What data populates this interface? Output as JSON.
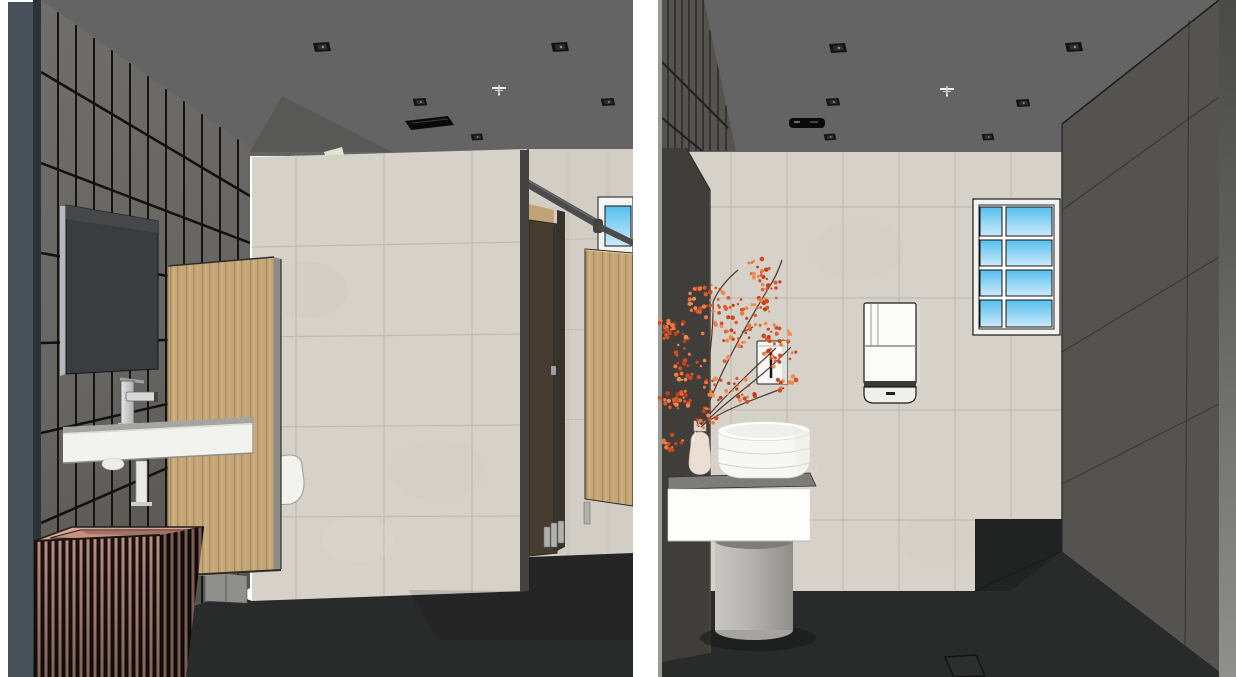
{
  "scene": {
    "description": "Two-view 3D interior rendering of a modern public restroom",
    "views": [
      {
        "id": "left-view",
        "elements": [
          "dark-tiled-wall",
          "wall-mirror",
          "chrome-faucet",
          "wall-hung-sink",
          "drain-pipe",
          "slatted-wood-basket",
          "wood-panel",
          "urinal",
          "beige-tile-partition",
          "toilet-stall-dark-door",
          "toilet-stall-wood-door",
          "stall-headrail",
          "stall-feet",
          "window-blue-glass",
          "ceiling-downlights",
          "air-vent",
          "fire-sprinkler",
          "dark-tile-floor"
        ]
      },
      {
        "id": "right-view",
        "elements": [
          "charcoal-wall-panel",
          "dark-tiled-wall-top",
          "beige-tile-wall",
          "soap-dispenser",
          "hand-dryer",
          "window-blue-glass-2x4",
          "dark-right-wall",
          "white-counter",
          "vessel-sink",
          "ceramic-vase",
          "orange-berry-branches",
          "gray-pedestal",
          "ceiling-downlights",
          "air-vent",
          "fire-sprinkler",
          "floor-drain",
          "dark-tile-floor"
        ]
      }
    ]
  },
  "palette": {
    "page_bg": "#ffffff",
    "ceiling": "#646464",
    "dark_wall_tile": "#6c6a66",
    "grout_dark": "#141414",
    "beige_tile": "#d6d2c9",
    "beige_grout": "#bfbbb2",
    "wood": "#c3a577",
    "dark_stall_door": "#463d32",
    "headrail": "#4c4c4c",
    "window_blue_top": "#55bfed",
    "window_blue_bottom": "#cdeafb",
    "floor": "#292b2a",
    "mirror": "#3a3c3e",
    "sink_white": "#f2f2ef",
    "basket_slat_pink": "#bd8d80",
    "basket_slat_dark": "#17120f",
    "charcoal_panel": "#403e3b",
    "right_wall": "#55534f",
    "counter_white": "#fefefd",
    "counter_top": "#7c7c79",
    "pedestal_gray": "#b8b6b3",
    "vase_cream": "#ebdfd4",
    "berry_orange": "#e05a2a",
    "branch_brown": "#53392a",
    "edge_blue_gray": "#49515a"
  }
}
